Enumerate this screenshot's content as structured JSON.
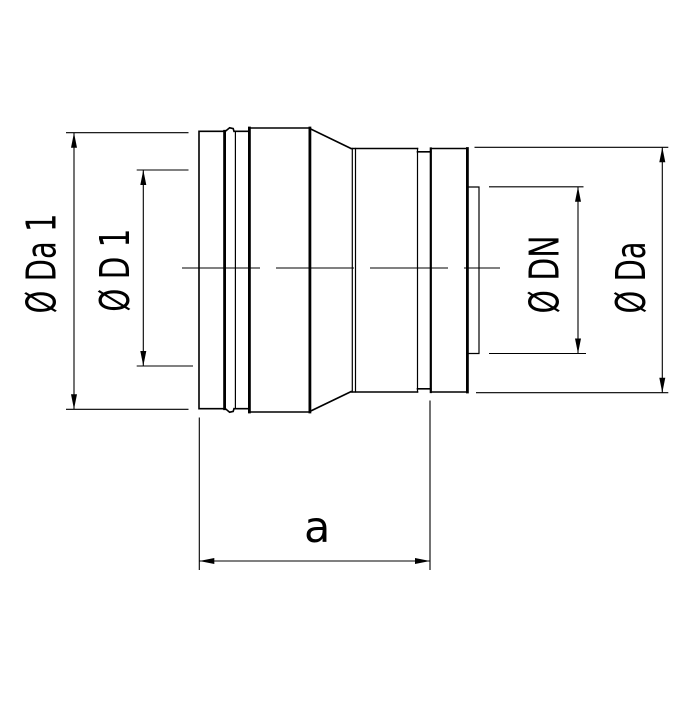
{
  "drawing": {
    "title": "pipe-reducer-fitting-side-view",
    "colors": {
      "line": "#000000",
      "background": "#ffffff"
    },
    "labels": {
      "diameter_da1": "Ø Da 1",
      "diameter_d1": "Ø D 1",
      "diameter_dn": "Ø DN",
      "diameter_da": "Ø Da",
      "length_a": "a"
    }
  }
}
